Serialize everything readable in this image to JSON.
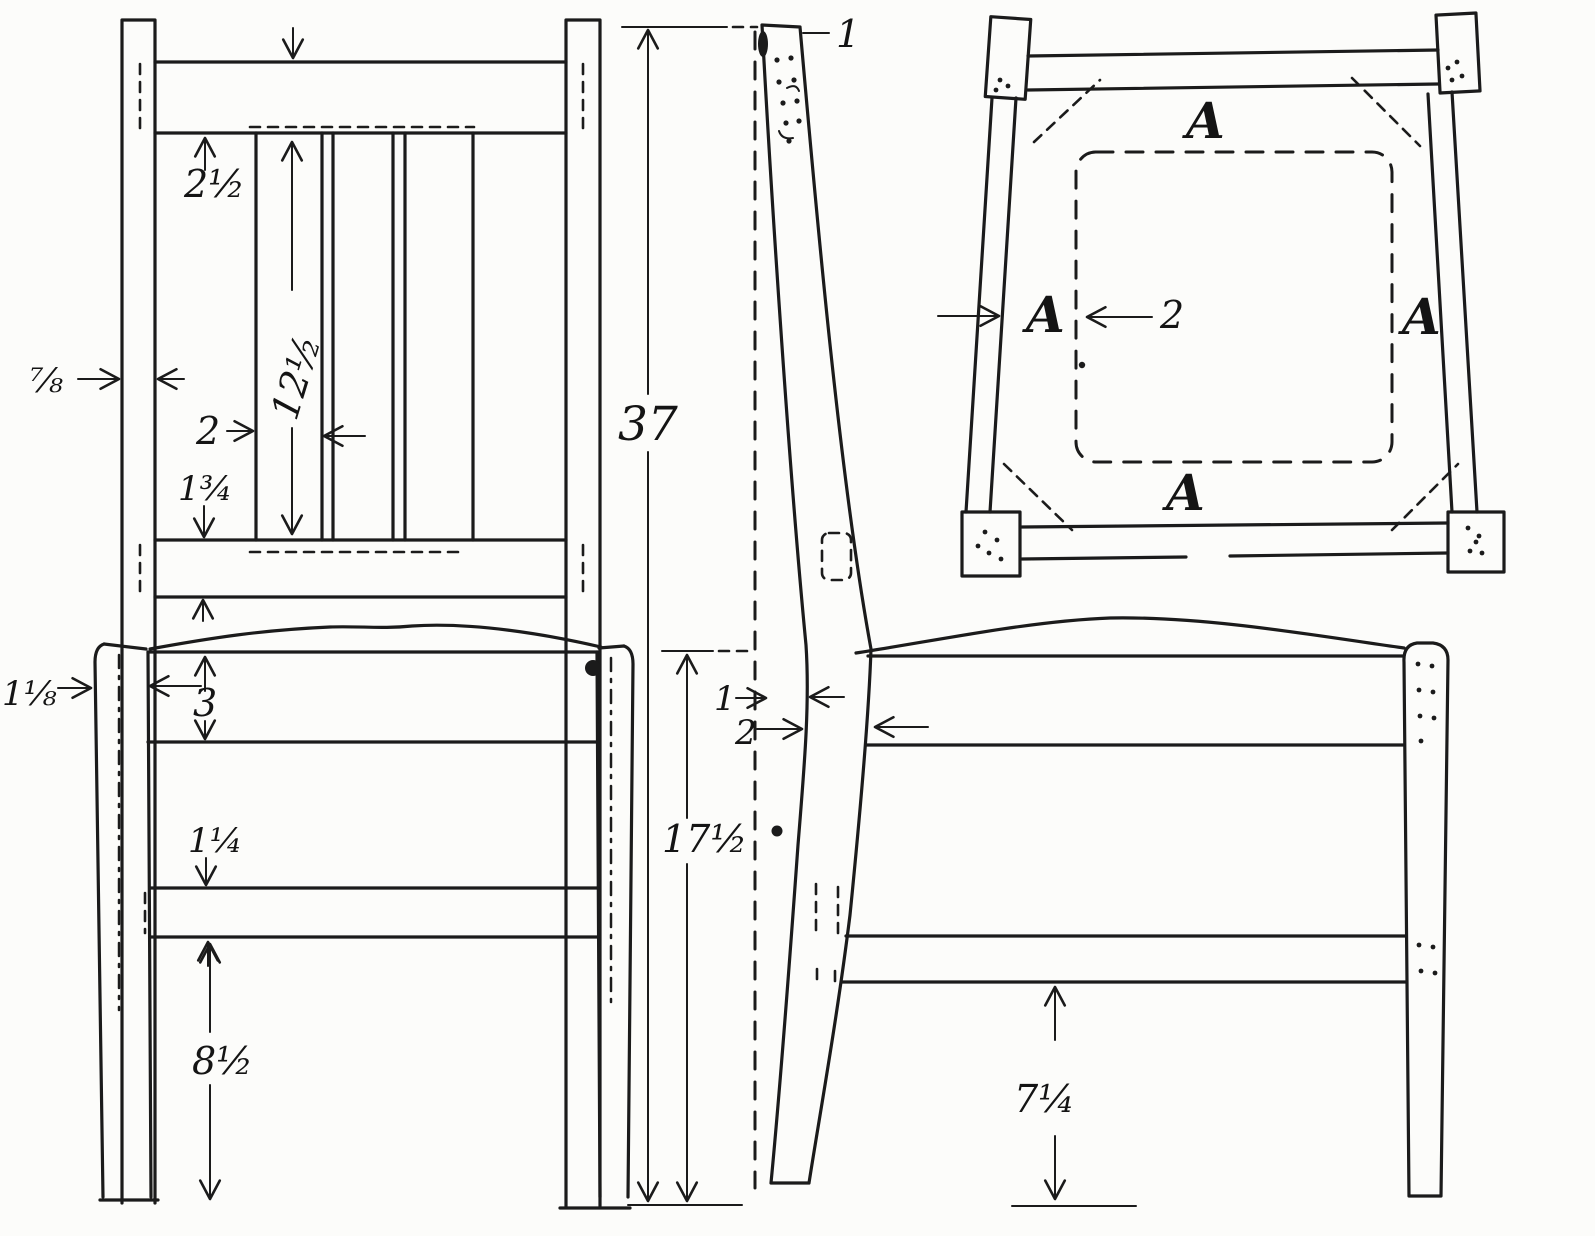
{
  "figure": {
    "type": "furniture working drawing",
    "subject": "dining chair: front elevation, side elevation and seat plan",
    "ink_color": "#1b1b1b",
    "paper_color": "#fcfcfa"
  },
  "front_view": {
    "crest_rail_thickness": "2½",
    "slat_length": "12½",
    "slat_width": "2",
    "lower_back_rail_width": "1¾",
    "back_post_thickness": "⅞",
    "front_leg_thickness": "1⅛",
    "seat_rail_depth": "3",
    "front_stretcher_depth": "1¼",
    "stretcher_to_floor": "8½"
  },
  "side_view": {
    "overall_height": "37",
    "seat_height": "17½",
    "post_top_depth": "1",
    "post_setback": "1",
    "post_seat_depth": "2",
    "side_stretcher_to_floor": "7¼"
  },
  "plan_view": {
    "back_rail": "A",
    "left_rail": "A",
    "right_rail": "A",
    "front_rail": "A",
    "seat_inset": "2"
  }
}
